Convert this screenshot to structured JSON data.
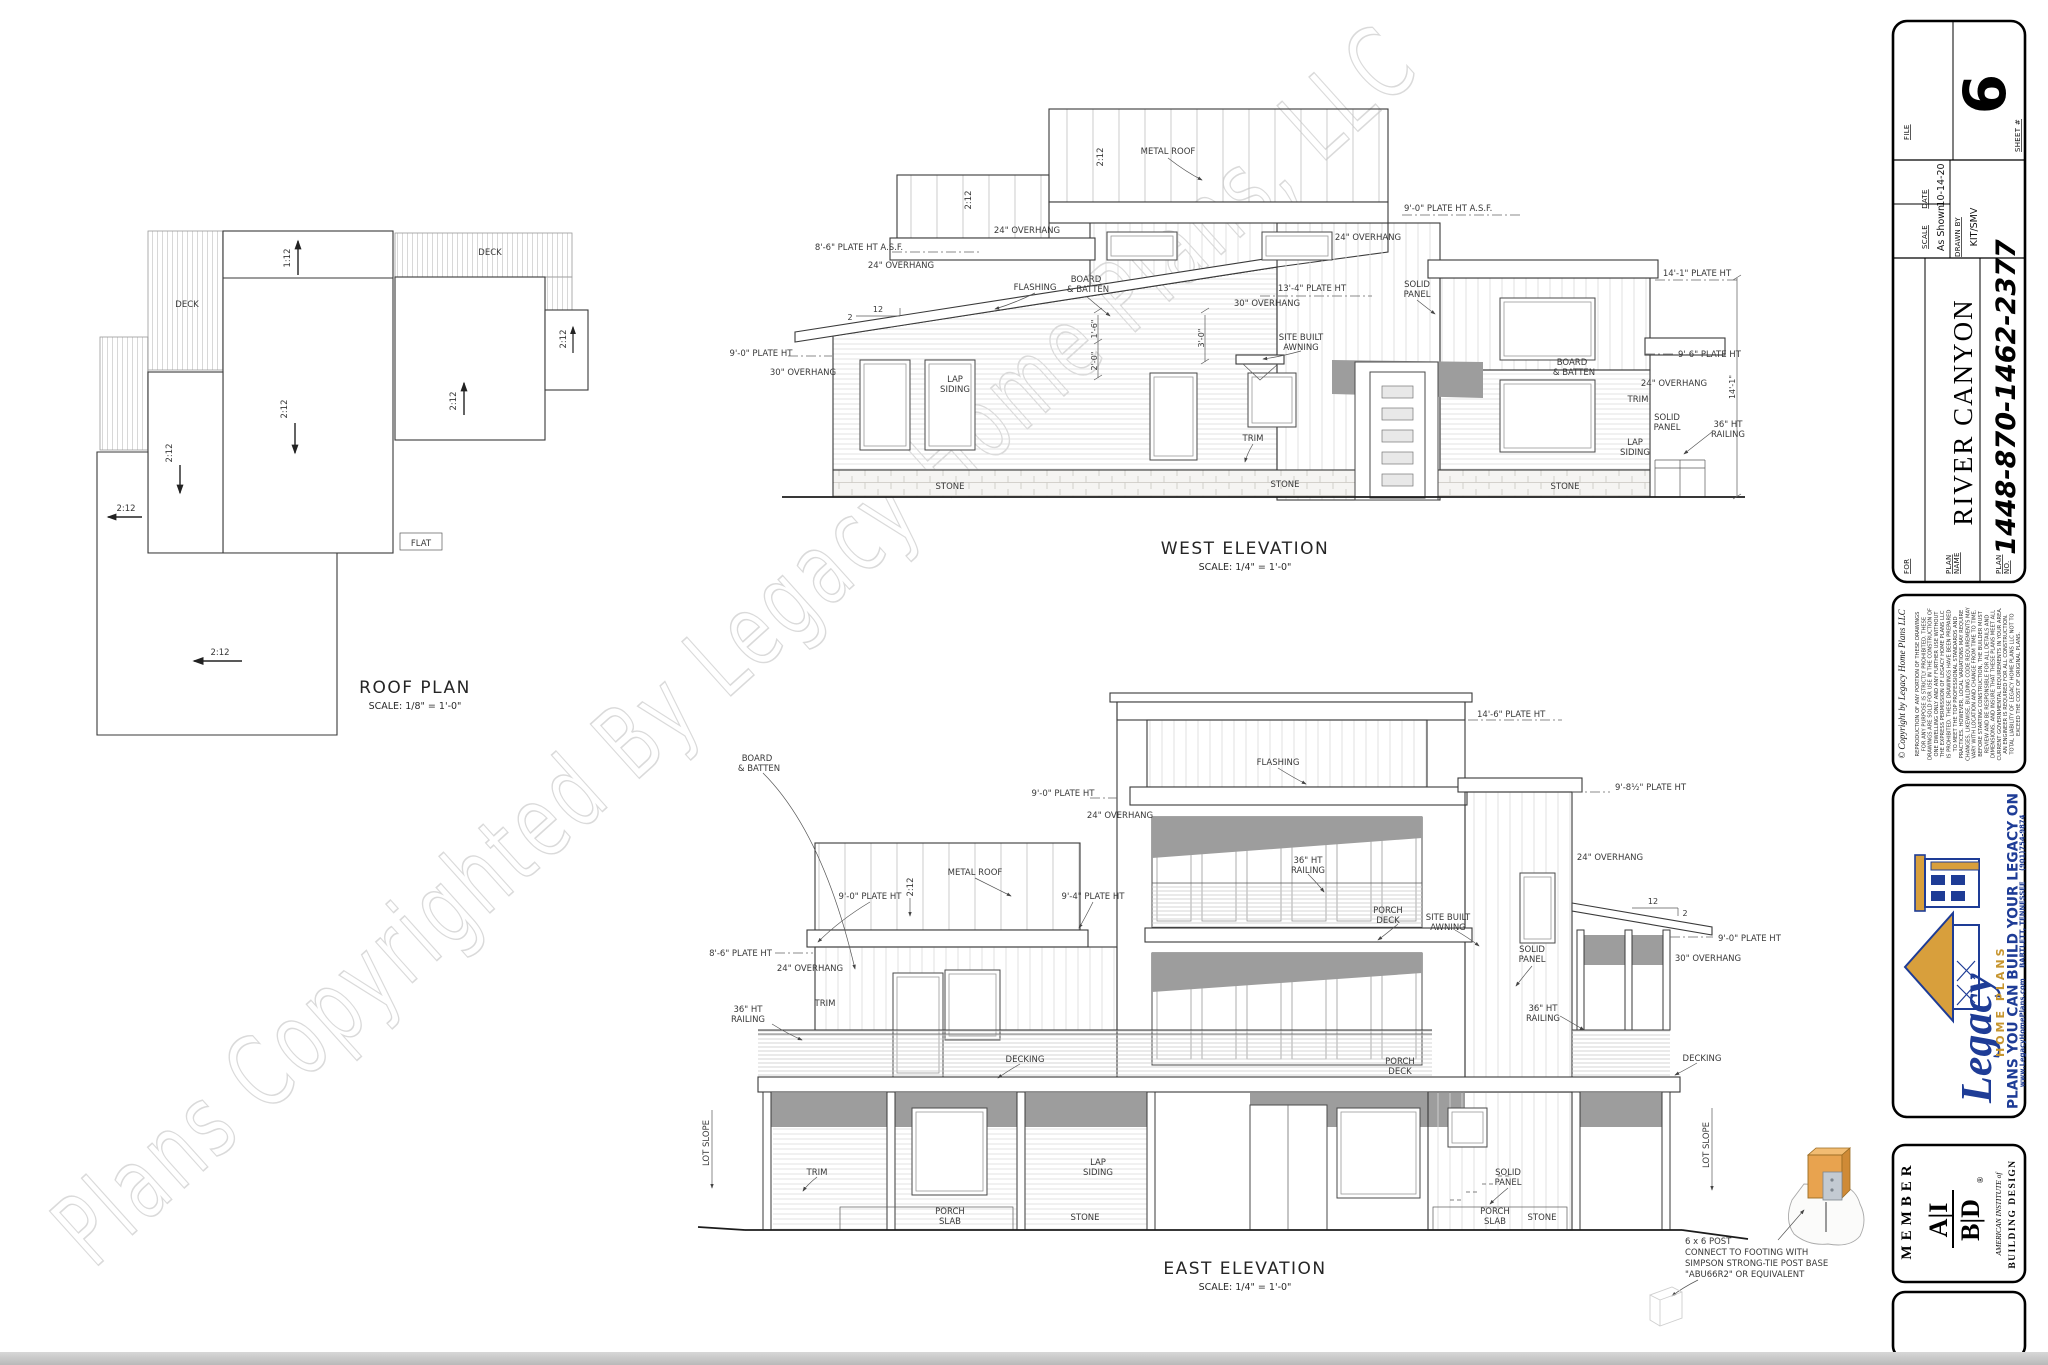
{
  "watermark": "Plans Copyrighted By Legacy Home Plans, LLC",
  "colors": {
    "brand_blue": "#1e3c96",
    "brand_gold": "#c6952f",
    "post_orange": "#e8a34f"
  },
  "L": {
    "metal_roof": "METAL ROOF",
    "o24": "24\" OVERHANG",
    "o30": "30\" OVERHANG",
    "board": "BOARD",
    "batten": "& BATTEN",
    "flashing": "FLASHING",
    "solid": "SOLID",
    "panel": "PANEL",
    "lap": "LAP",
    "siding": "SIDING",
    "trim": "TRIM",
    "stone": "STONE",
    "decking": "DECKING",
    "r36a": "36\" HT",
    "r36b": "RAILING",
    "porch": "PORCH",
    "deckw": "DECK",
    "slab": "SLAB",
    "site1": "SITE BUILT",
    "site2": "AWNING",
    "lot": "LOT SLOPE",
    "s212": "2:12",
    "s112": "1:12",
    "s12": "12",
    "s2": "2",
    "p90": "9'-0\" PLATE HT",
    "p90asf": "9'-0\" PLATE HT A.S.F.",
    "p86asf": "8'-6\" PLATE HT A.S.F.",
    "p86": "8'-6\" PLATE HT",
    "p134": "13'-4\" PLATE HT",
    "p141": "14'-1\" PLATE HT",
    "p96": "9'-6\" PLATE HT",
    "p146": "14'-6\" PLATE HT",
    "p94": "9'-4\" PLATE HT",
    "p985": "9'-8½\" PLATE HT",
    "d141": "14'-1\"",
    "d30": "3'-0\"",
    "d16": "1'-6\"",
    "d20": "2'-0\"",
    "deck": "DECK",
    "flat": "FLAT"
  },
  "roof_plan": {
    "title": "ROOF PLAN",
    "scale": "SCALE: 1/8\" = 1'-0\""
  },
  "west": {
    "title": "WEST ELEVATION",
    "scale": "SCALE: 1/4\" = 1'-0\""
  },
  "east": {
    "title": "EAST ELEVATION",
    "scale": "SCALE: 1/4\" = 1'-0\""
  },
  "post_note": {
    "l1": "6 x 6 POST",
    "l2": "CONNECT TO FOOTING WITH",
    "l3": "SIMPSON STRONG-TIE POST BASE",
    "l4": "\"ABU66R2\" OR EQUIVALENT"
  },
  "sheet": {
    "file_label": "FILE",
    "sheet_label": "SHEET #",
    "sheet_number": "6",
    "date_label": "DATE",
    "date": "10-14-20",
    "scale_label": "SCALE",
    "scale": "As Shown",
    "drawn_label": "DRAWN BY",
    "drawn_by": "KIT/SMV",
    "for_label": "FOR",
    "plan_label_1": "PLAN",
    "plan_name_label_2": "NAME",
    "plan_no_label_2": "NO.",
    "plan_name": "RIVER CANYON",
    "plan_no": "1448-870-1462-2377",
    "copyright": {
      "title": "© Copyright by Legacy Home Plans LLC",
      "lines": [
        "REPRODUCTION OF ANY PORTION OF THESE DRAWINGS",
        "FOR ANY PURPOSE IS STRICTLY PROHIBITED. THESE",
        "DRAWINGS ARE SOLD FOR USE IN THE CONSTRUCTION OF",
        "ONE DWELLING ONLY AND ANY FURTHER USE WITHOUT",
        "THE EXPRESS PERMISSION OF LEGACY HOME PLANS LLC",
        "IS PROHIBITED. THESE DRAWINGS HAVE BEEN PREPARED",
        "TO MEET THE TOP PROFESSIONAL STANDARDS AND",
        "PRACTICES. HOWEVER, LOCAL VARIATIONS MAY REQUIRE",
        "CHANGES. LIKEWISE, BUILDING CODE REQUIREMENTS MAY",
        "VARY WITH LOCATION AND CHANGE FROM TIME TO TIME.",
        "BEFORE STARTING CONSTRUCTION, THE BUILDER MUST",
        "REVIEW AND BE RESPONSIBLE FOR ALL DETAILS AND",
        "DIMENSIONS, AND INSURE THAT THESE PLANS MEET ALL",
        "CURRENT GOVERNMENTAL REQUIREMENTS IN YOUR AREA.",
        "AN ENGINEER IS REQUIRED FOR ALL CONSTRUCTION.",
        "TOTAL LIABILITY OF LEGACY HOME PLANS LLC NOT TO",
        "EXCEED THE COST OF ORIGINAL PLANS."
      ]
    },
    "logo": {
      "name": "Legacy",
      "sub": "HOME PLANS",
      "tagline": "PLANS YOU CAN BUILD YOUR LEGACY ON",
      "website": "www.LegacyHomePlans.com",
      "city": "BARTLETT, TENNESSEE",
      "phone": "(901)754-9874"
    },
    "member": {
      "label": "MEMBER",
      "org_top": "A|I",
      "org_bottom": "B|D",
      "reg": "®",
      "org_line1": "AMERICAN INSTITUTE of",
      "org_line2": "BUILDING DESIGN"
    }
  }
}
